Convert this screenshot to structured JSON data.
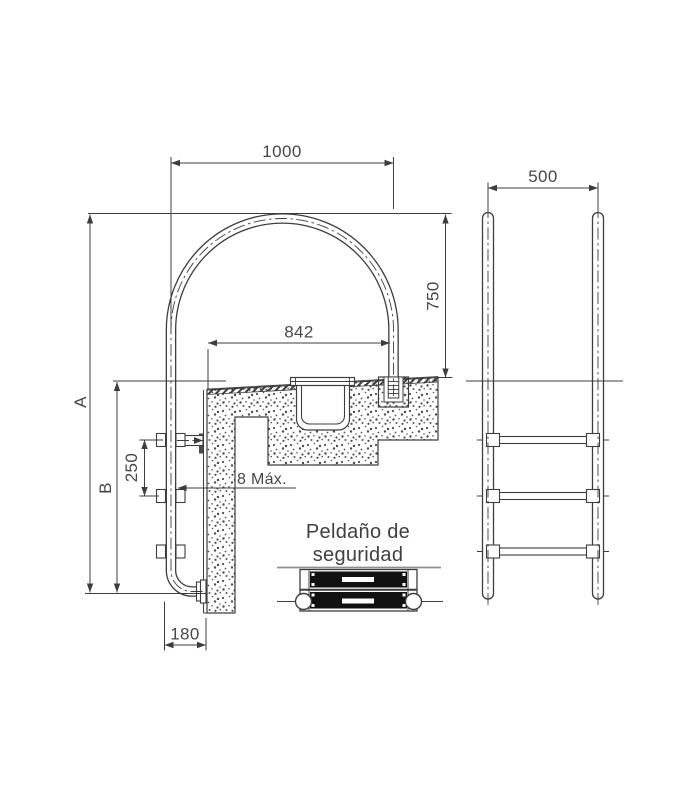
{
  "drawing": {
    "labels": {
      "span_top": "1000",
      "front_width": "500",
      "height_right": "750",
      "anchor_span": "842",
      "rung_spacing": "250",
      "wall_offset": "180",
      "gap_note": "8 Máx.",
      "dim_a": "A",
      "dim_b": "B",
      "note_line1": "Peldaño de",
      "note_line2": "seguridad"
    },
    "colors": {
      "line": "#3d3d3d",
      "text": "#474747",
      "tread_black": "#111111",
      "separator_gray": "#8f8f8f",
      "background": "#ffffff"
    }
  }
}
